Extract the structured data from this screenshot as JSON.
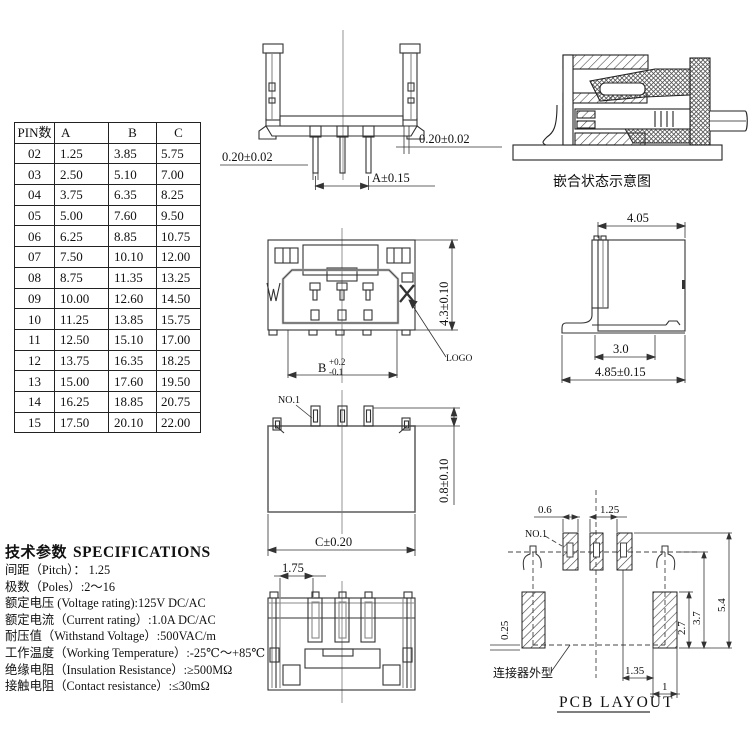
{
  "pin_table": {
    "headers": [
      "PIN数",
      "A",
      "B",
      "C"
    ],
    "rows": [
      [
        "02",
        "1.25",
        "3.85",
        "5.75"
      ],
      [
        "03",
        "2.50",
        "5.10",
        "7.00"
      ],
      [
        "04",
        "3.75",
        "6.35",
        "8.25"
      ],
      [
        "05",
        "5.00",
        "7.60",
        "9.50"
      ],
      [
        "06",
        "6.25",
        "8.85",
        "10.75"
      ],
      [
        "07",
        "7.50",
        "10.10",
        "12.00"
      ],
      [
        "08",
        "8.75",
        "11.35",
        "13.25"
      ],
      [
        "09",
        "10.00",
        "12.60",
        "14.50"
      ],
      [
        "10",
        "11.25",
        "13.85",
        "15.75"
      ],
      [
        "11",
        "12.50",
        "15.10",
        "17.00"
      ],
      [
        "12",
        "13.75",
        "16.35",
        "18.25"
      ],
      [
        "13",
        "15.00",
        "17.60",
        "19.50"
      ],
      [
        "14",
        "16.25",
        "18.85",
        "20.75"
      ],
      [
        "15",
        "17.50",
        "20.10",
        "22.00"
      ]
    ]
  },
  "specifications": {
    "title_cn": "技术参数",
    "title_en": "SPECIFICATIONS",
    "lines": [
      "间距（Pitch）： 1.25",
      "极数（Poles）:2～16",
      "额定电压 (Voltage rating):125V DC/AC",
      "额定电流（Current rating）:1.0A DC/AC",
      "耐压值（Withstand Voltage）:500VAC/m",
      "工作温度（Working Temperature）:-25℃～+85℃",
      "绝缘电阻（Insulation Resistance）:≥500MΩ",
      "接触电阻（Contact resistance）:≤30mΩ"
    ]
  },
  "drawings": {
    "front_section": {
      "dim_pin_left": "0.20±0.02",
      "dim_shell_right": "0.20±0.02",
      "dim_a": "A±0.15"
    },
    "mating_view": {
      "caption": "嵌合状态示意图"
    },
    "front_view": {
      "dim_height": "4.3±0.10",
      "dim_b_letter": "B",
      "dim_b_plus": "+0.2",
      "dim_b_minus": "-0.1",
      "logo_label": "LOGO"
    },
    "side_view": {
      "dim_top": "4.05",
      "dim_mid": "3.0",
      "dim_bottom": "4.85±0.15"
    },
    "back_view": {
      "pin1_label": "NO.1",
      "dim_pin_height": "0.8±0.10",
      "dim_c": "C±0.20"
    },
    "bottom_view": {
      "dim_end": "1.75"
    },
    "pcb_layout": {
      "title": "PCB LAYOUT",
      "pin1_label": "NO.1",
      "outline_label": "连接器外型",
      "dim_pad_width": "0.6",
      "dim_pitch": "1.25",
      "dim_left_offset": "0.25",
      "dim_pad_h": "2.7",
      "dim_mid_h": "3.7",
      "dim_total_h": "5.4",
      "dim_gap": "1.35",
      "dim_side_pad_w": "1"
    }
  }
}
